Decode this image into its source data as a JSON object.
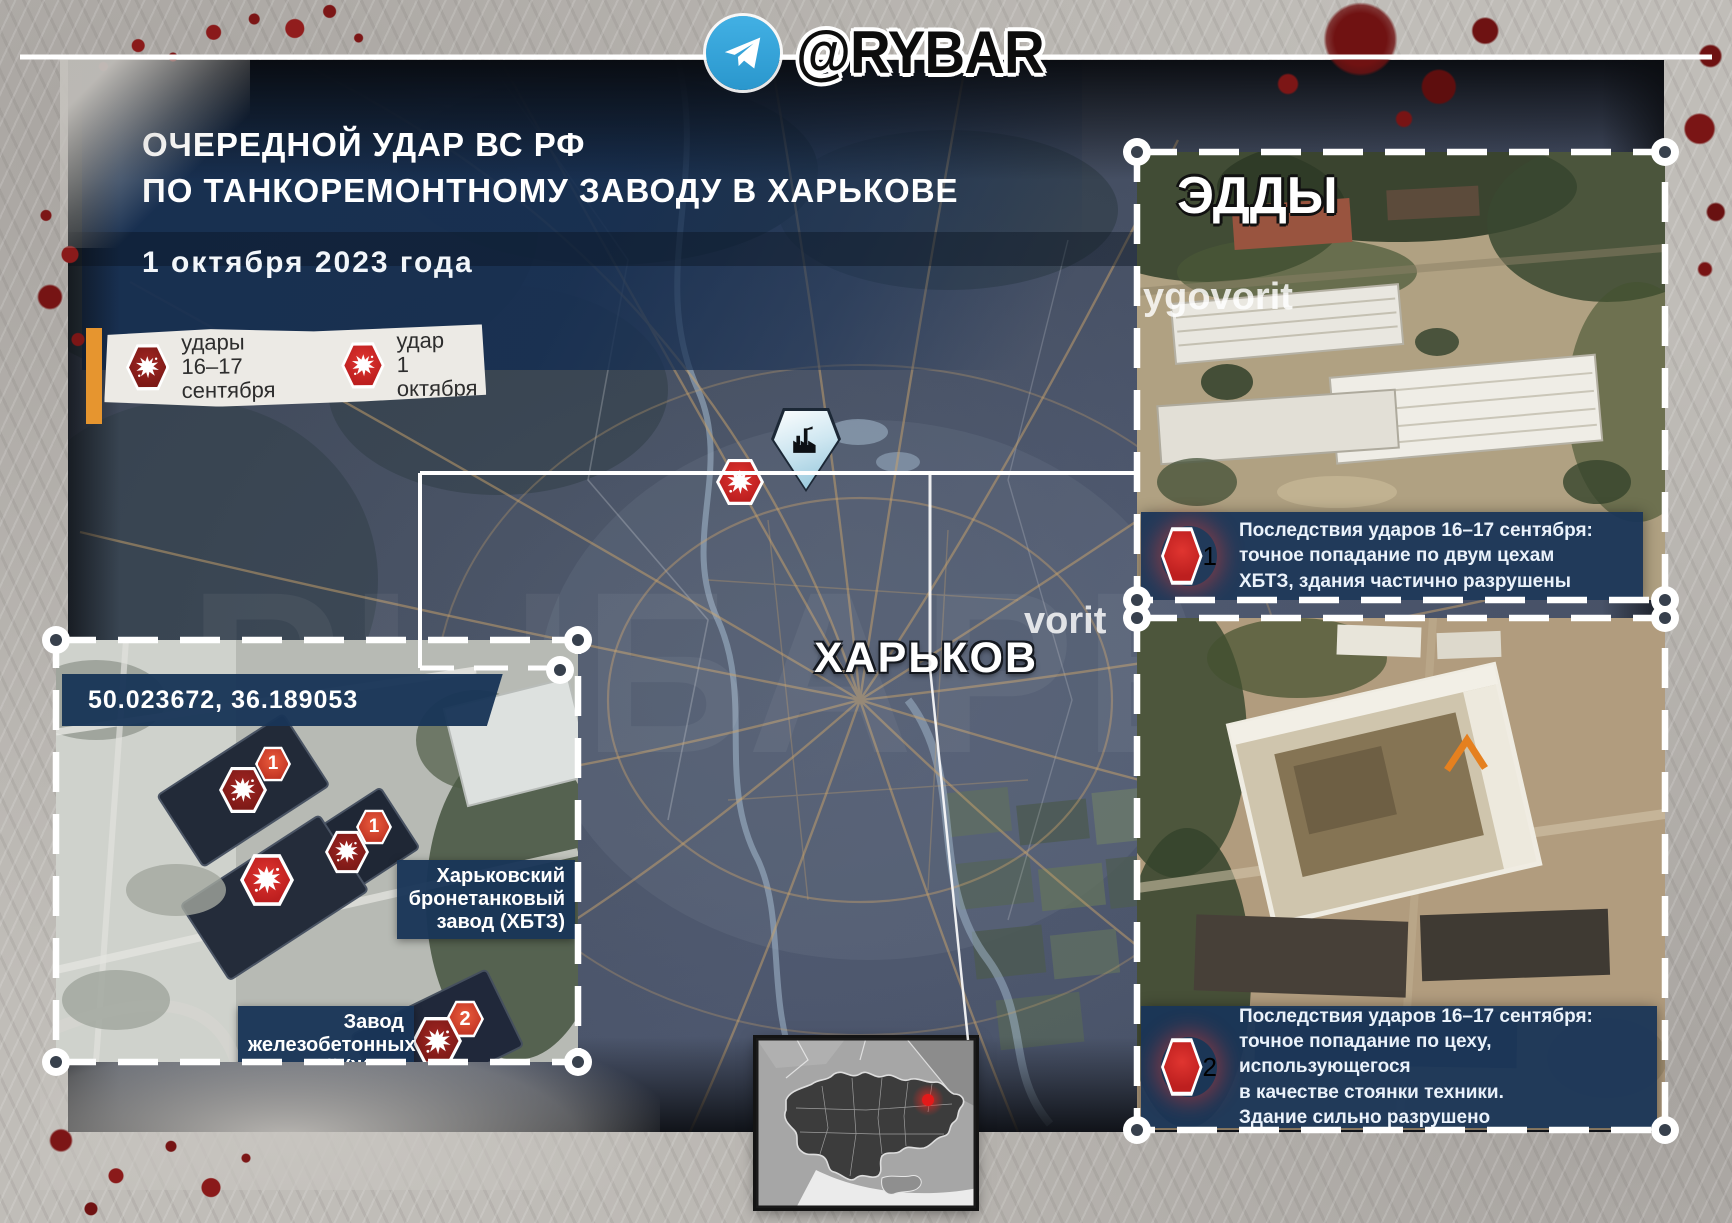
{
  "header": {
    "brand": "@RYBAR"
  },
  "title": {
    "line1": "ОЧЕРЕДНОЙ УДАР ВС РФ",
    "line2": "ПО ТАНКОРЕМОНТНОМУ ЗАВОДУ В ХАРЬКОВЕ",
    "date": "1 октября 2023 года"
  },
  "legend": {
    "items": [
      {
        "label": "удары\n16–17 сентября",
        "type": "strikes-16-17-september",
        "color": "#7e1a17"
      },
      {
        "label": "удар\n1 октября",
        "type": "strike-1-october",
        "color": "#bd1f1f"
      }
    ]
  },
  "map": {
    "city_label": "ХАРЬКОВ",
    "watermark": "РЫБАРЬ"
  },
  "insets": {
    "top_right": {
      "watermark_line1": "ЭДДЫ",
      "watermark_line2": "ygovorit",
      "badge": "1",
      "caption": "Последствия ударов 16–17 сентября:\nточное попадание по двум цехам\nХБТЗ, здания частично разрушены"
    },
    "bottom_left": {
      "coordinates": "50.023672, 36.189053",
      "labels": {
        "khbtz": "Харьковский\nбронетанковый\nзавод (ХБТЗ)",
        "zhbi": "Завод\nжелезобетонных\nизделий (ЖБИ)"
      },
      "marker_badges": {
        "m1": "1",
        "m2": "1",
        "zhbi": "2"
      }
    },
    "bottom_right": {
      "watermark": "vorit",
      "badge": "2",
      "caption": "Последствия ударов 16–17 сентября:\nточное попадание по цеху, использующегося\nв качестве стоянки техники.\nЗдание сильно разрушено"
    }
  },
  "colors": {
    "panel_navy": "#1d3a5c",
    "strike_old_red": "#7e1a17",
    "strike_new_red": "#bd1f1f",
    "legend_orange": "#e6952f",
    "telegram_blue": "#34a6dd",
    "location_dot_red": "#e31a1a"
  }
}
